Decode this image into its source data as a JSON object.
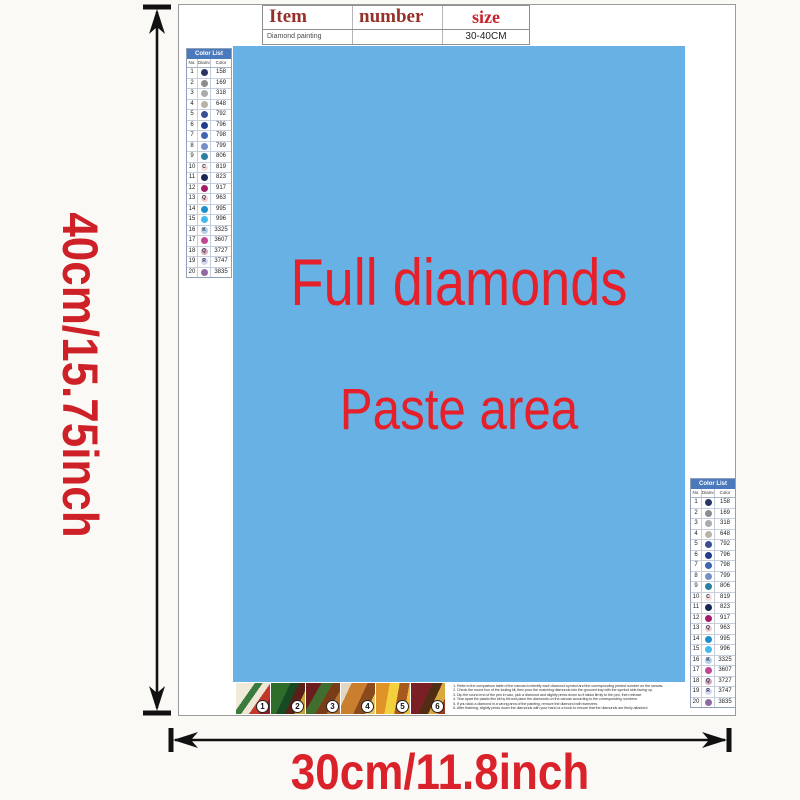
{
  "palette": {
    "accent_red": "#D9222A",
    "paste_bg_blue": "#68B1E4",
    "paste_text_red": "#E5202A",
    "table_header_dark_red": "#96302A",
    "table_size_red": "#C5232B",
    "list_header_blue": "#4A79BC"
  },
  "dim_labels": {
    "height": "40cm/15.75inch",
    "width": "30cm/11.8inch"
  },
  "item_table": {
    "col_item": "Item",
    "col_number": "number",
    "col_size": "size",
    "row_item": "Diamond painting",
    "row_number": "",
    "row_size": "30-40CM"
  },
  "paste_area": {
    "line1": "Full diamonds",
    "line2": "Paste area"
  },
  "color_list": {
    "title": "Color List",
    "col_no": "No.",
    "col_diamond": "Diamond",
    "col_color": "Color",
    "rows": [
      {
        "no": "1",
        "symbol": "",
        "code": "158",
        "color": "#2A3663",
        "symbol_color": "#FFFFFF"
      },
      {
        "no": "2",
        "symbol": "",
        "code": "169",
        "color": "#8A8C8E",
        "symbol_color": "#FFFFFF"
      },
      {
        "no": "3",
        "symbol": "",
        "code": "318",
        "color": "#A9ABAD",
        "symbol_color": "#FFFFFF"
      },
      {
        "no": "4",
        "symbol": "",
        "code": "648",
        "color": "#B8B2A7",
        "symbol_color": "#FFFFFF"
      },
      {
        "no": "5",
        "symbol": "",
        "code": "792",
        "color": "#3A4E94",
        "symbol_color": "#FFFFFF"
      },
      {
        "no": "6",
        "symbol": "",
        "code": "796",
        "color": "#203C8C",
        "symbol_color": "#FFFFFF"
      },
      {
        "no": "7",
        "symbol": "",
        "code": "798",
        "color": "#3E66B0",
        "symbol_color": "#FFFFFF"
      },
      {
        "no": "8",
        "symbol": "",
        "code": "799",
        "color": "#7490C8",
        "symbol_color": "#FFFFFF"
      },
      {
        "no": "9",
        "symbol": "",
        "code": "806",
        "color": "#2B7FA3",
        "symbol_color": "#FFFFFF"
      },
      {
        "no": "10",
        "symbol": "C",
        "code": "819",
        "color": "#F6DFDA",
        "symbol_color": "#27355C"
      },
      {
        "no": "11",
        "symbol": "",
        "code": "823",
        "color": "#182654",
        "symbol_color": "#FFFFFF"
      },
      {
        "no": "12",
        "symbol": "",
        "code": "917",
        "color": "#A21E68",
        "symbol_color": "#FFFFFF"
      },
      {
        "no": "13",
        "symbol": "Q",
        "code": "963",
        "color": "#F6CDD0",
        "symbol_color": "#27355C"
      },
      {
        "no": "14",
        "symbol": "",
        "code": "995",
        "color": "#1F8FCC",
        "symbol_color": "#FFFFFF"
      },
      {
        "no": "15",
        "symbol": "",
        "code": "996",
        "color": "#45B9EA",
        "symbol_color": "#FFFFFF"
      },
      {
        "no": "16",
        "symbol": "K",
        "code": "3325",
        "color": "#B5D1E8",
        "symbol_color": "#27355C"
      },
      {
        "no": "17",
        "symbol": "",
        "code": "3607",
        "color": "#C04793",
        "symbol_color": "#FFFFFF"
      },
      {
        "no": "18",
        "symbol": "Q",
        "code": "3727",
        "color": "#D9A9BC",
        "symbol_color": "#27355C"
      },
      {
        "no": "19",
        "symbol": "R",
        "code": "3747",
        "color": "#D6D9F0",
        "symbol_color": "#27355C"
      },
      {
        "no": "20",
        "symbol": "",
        "code": "3835",
        "color": "#8F6BA2",
        "symbol_color": "#FFFFFF"
      }
    ]
  },
  "steps": {
    "items": [
      {
        "num": "1"
      },
      {
        "num": "2"
      },
      {
        "num": "3"
      },
      {
        "num": "4"
      },
      {
        "num": "5"
      },
      {
        "num": "6"
      }
    ]
  },
  "instructions": {
    "lines": [
      "1. Refer to the comparison table of the canvas to identify each diamond symbol and the corresponding printed number on the canvas.",
      "2. Check the round box of the tooling kit, then pour the matching diamonds into the grooved tray with the symbol side facing up.",
      "3. Dip the round end of the pen in wax, pick a diamond and slightly press down so it sticks firmly to the pen, then release.",
      "4. Tear apart the plastic film bit by bit and place the diamonds on the canvas according to the corresponding numbers.",
      "5. If you stick a diamond in a wrong area of the painting, remove the diamond with tweezers.",
      "6. After finishing, slightly press down the diamonds with your hand or a book to ensure that the diamonds are firmly attached."
    ]
  }
}
